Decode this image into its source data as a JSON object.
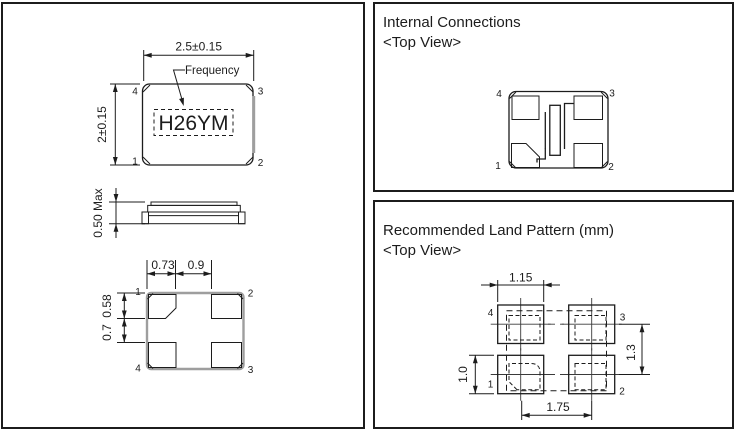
{
  "package": {
    "marking": "H26YM",
    "marking_caption": "Frequency"
  },
  "dimension_view": {
    "top": {
      "width": "2.5±0.15",
      "height": "2±0.15",
      "pin_tl": "4",
      "pin_tr": "3",
      "pin_bl": "1",
      "pin_br": "2"
    },
    "side": {
      "height": "0.50 Max"
    },
    "bottom": {
      "pad_width": "0.73",
      "pad_gap": "0.9",
      "pad_height": "0.58",
      "pad_vgap": "0.7",
      "pin_tl": "1",
      "pin_tr": "2",
      "pin_bl": "4",
      "pin_br": "3"
    }
  },
  "internal_connections": {
    "title": "Internal Connections",
    "subtitle": "<Top View>",
    "pin_tl": "4",
    "pin_tr": "3",
    "pin_bl": "1",
    "pin_br": "2"
  },
  "land_pattern": {
    "title": "Recommended Land Pattern (mm)",
    "subtitle": "<Top View>",
    "pad_width": "1.15",
    "pad_height": "1.0",
    "row_pitch": "1.3",
    "col_pitch": "1.75",
    "pin_tl": "4",
    "pin_tr": "3",
    "pin_bl": "1",
    "pin_br": "2"
  },
  "colors": {
    "line": "#1c1c1c",
    "metallization_gray": "#9e9e9e"
  }
}
